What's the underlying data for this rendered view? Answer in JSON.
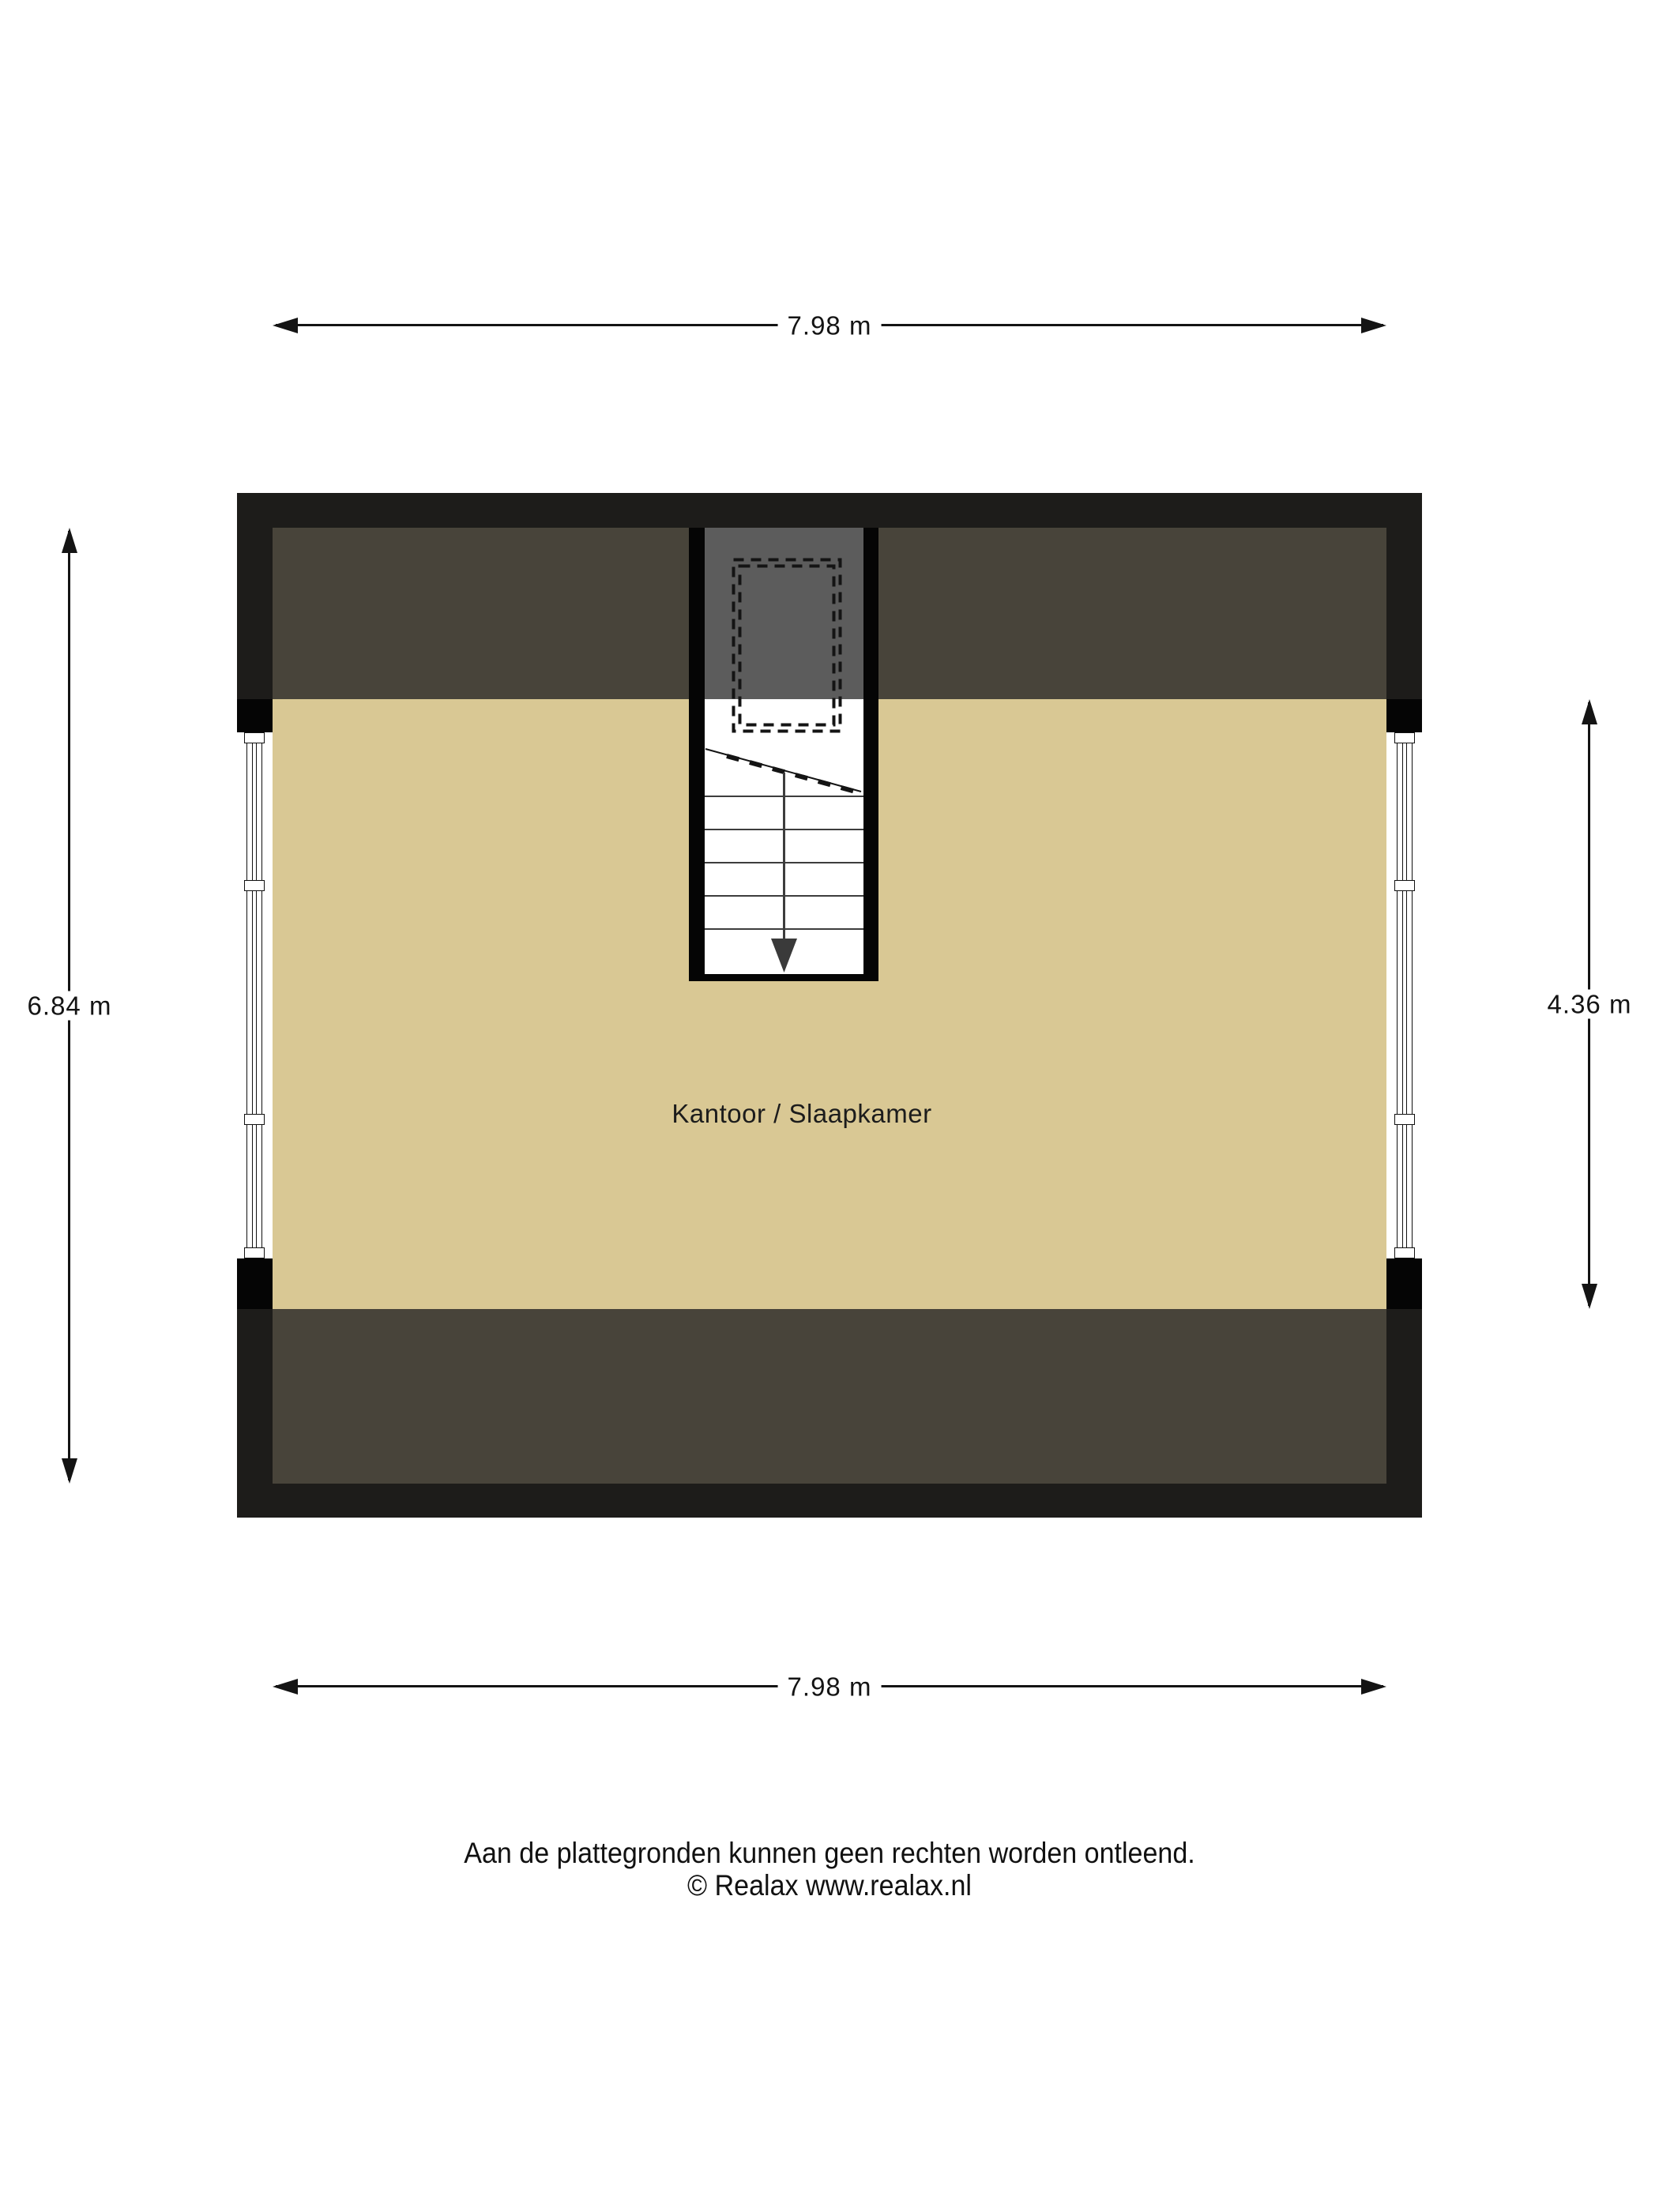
{
  "plan": {
    "room_label": "Kantoor / Slaapkamer"
  },
  "dimensions": {
    "top": "7.98 m",
    "bottom": "7.98 m",
    "left": "6.84 m",
    "right": "4.36 m"
  },
  "footer": {
    "disclaimer": "Aan de plattegronden kunnen geen rechten worden ontleend.",
    "copyright": "© Realax www.realax.nl"
  },
  "colors": {
    "wall": "#1d1c1a",
    "wall_black": "#050505",
    "sloped_ceiling": "#48443a",
    "floor": "#d9c894",
    "stairwell_upper": "#5c5c5c",
    "line": "#141414"
  }
}
